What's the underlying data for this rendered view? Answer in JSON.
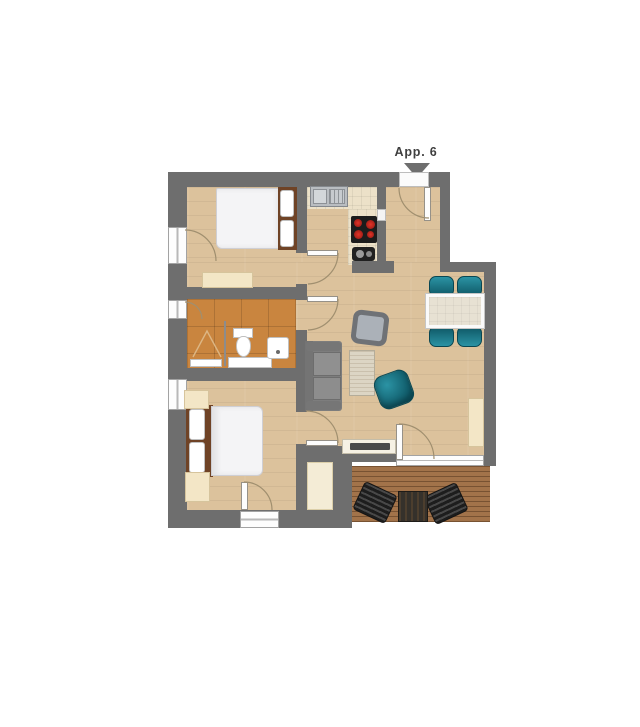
{
  "entrance": {
    "label": "App. 6",
    "marker_icon": "triangle-down"
  },
  "colors": {
    "wall": "#6e6e6e",
    "floor": "#dcc29c",
    "tile": "#c9853f",
    "deck": "#a2734a",
    "teal": "#15707f",
    "teal_light": "#2b93a4",
    "teal_dark": "#0e5765",
    "sofa": "#8a8a8a",
    "cream": "#f3e6c6",
    "duvet": "#f4f4f6",
    "wood_brown": "#6f4326",
    "counter": "#ece1c8",
    "arc": "#a08f6f",
    "label_text": "#3f3f3f"
  }
}
